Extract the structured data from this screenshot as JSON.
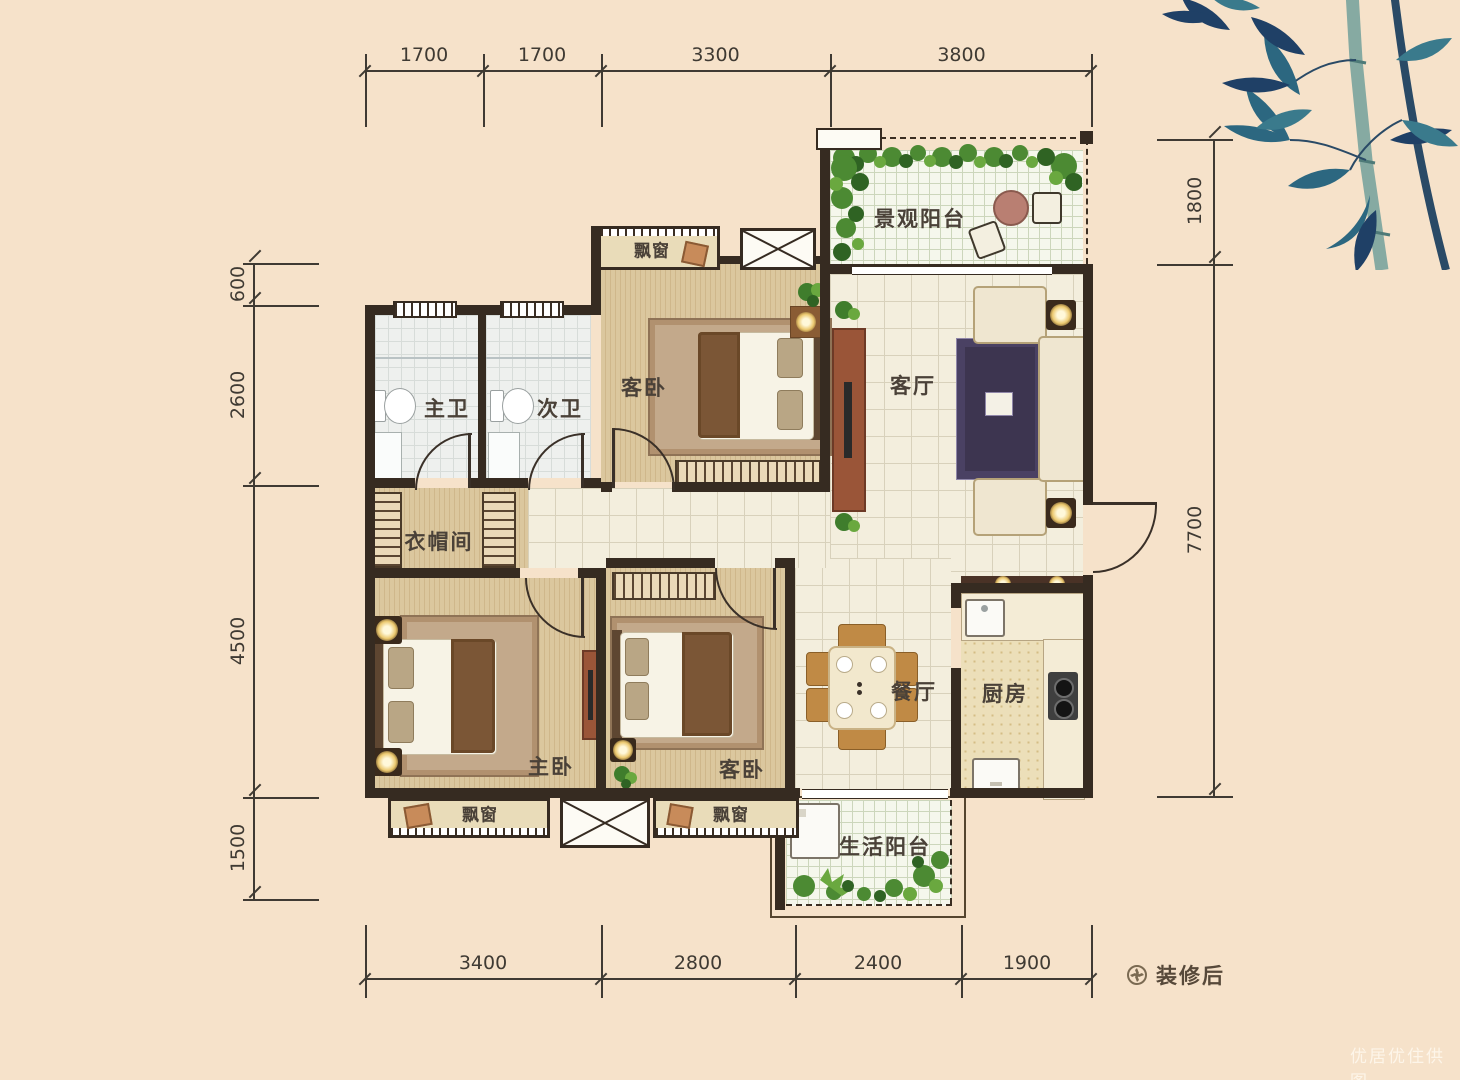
{
  "legend": {
    "label": "装修后"
  },
  "watermark": {
    "label": "优居优住供图"
  },
  "dims": {
    "top": [
      "1700",
      "1700",
      "3300",
      "3800"
    ],
    "bottom": [
      "3400",
      "2800",
      "2400",
      "1900"
    ],
    "left": [
      "600",
      "2600",
      "4500",
      "1500"
    ],
    "right": [
      "1800",
      "7700"
    ]
  },
  "rooms": {
    "view_balcony": "景观阳台",
    "master_bath": "主卫",
    "second_bath": "次卫",
    "guest_bed_top": "客卧",
    "living": "客厅",
    "cloak": "衣帽间",
    "master_bed": "主卧",
    "guest_bed_bottom": "客卧",
    "dining": "餐厅",
    "kitchen": "厨房",
    "bay_top": "飘窗",
    "bay_left": "飘窗",
    "bay_mid": "飘窗",
    "life_balcony": "生活阳台"
  },
  "colors": {
    "background": "#f6e2ca",
    "wall": "#362b21",
    "wood_floor": "#d9c49a",
    "tile_floor": "#f3eedd",
    "plant_green": "#4c8a33",
    "furniture_brown": "#9a5538",
    "bamboo_teal": "#2c6780"
  }
}
